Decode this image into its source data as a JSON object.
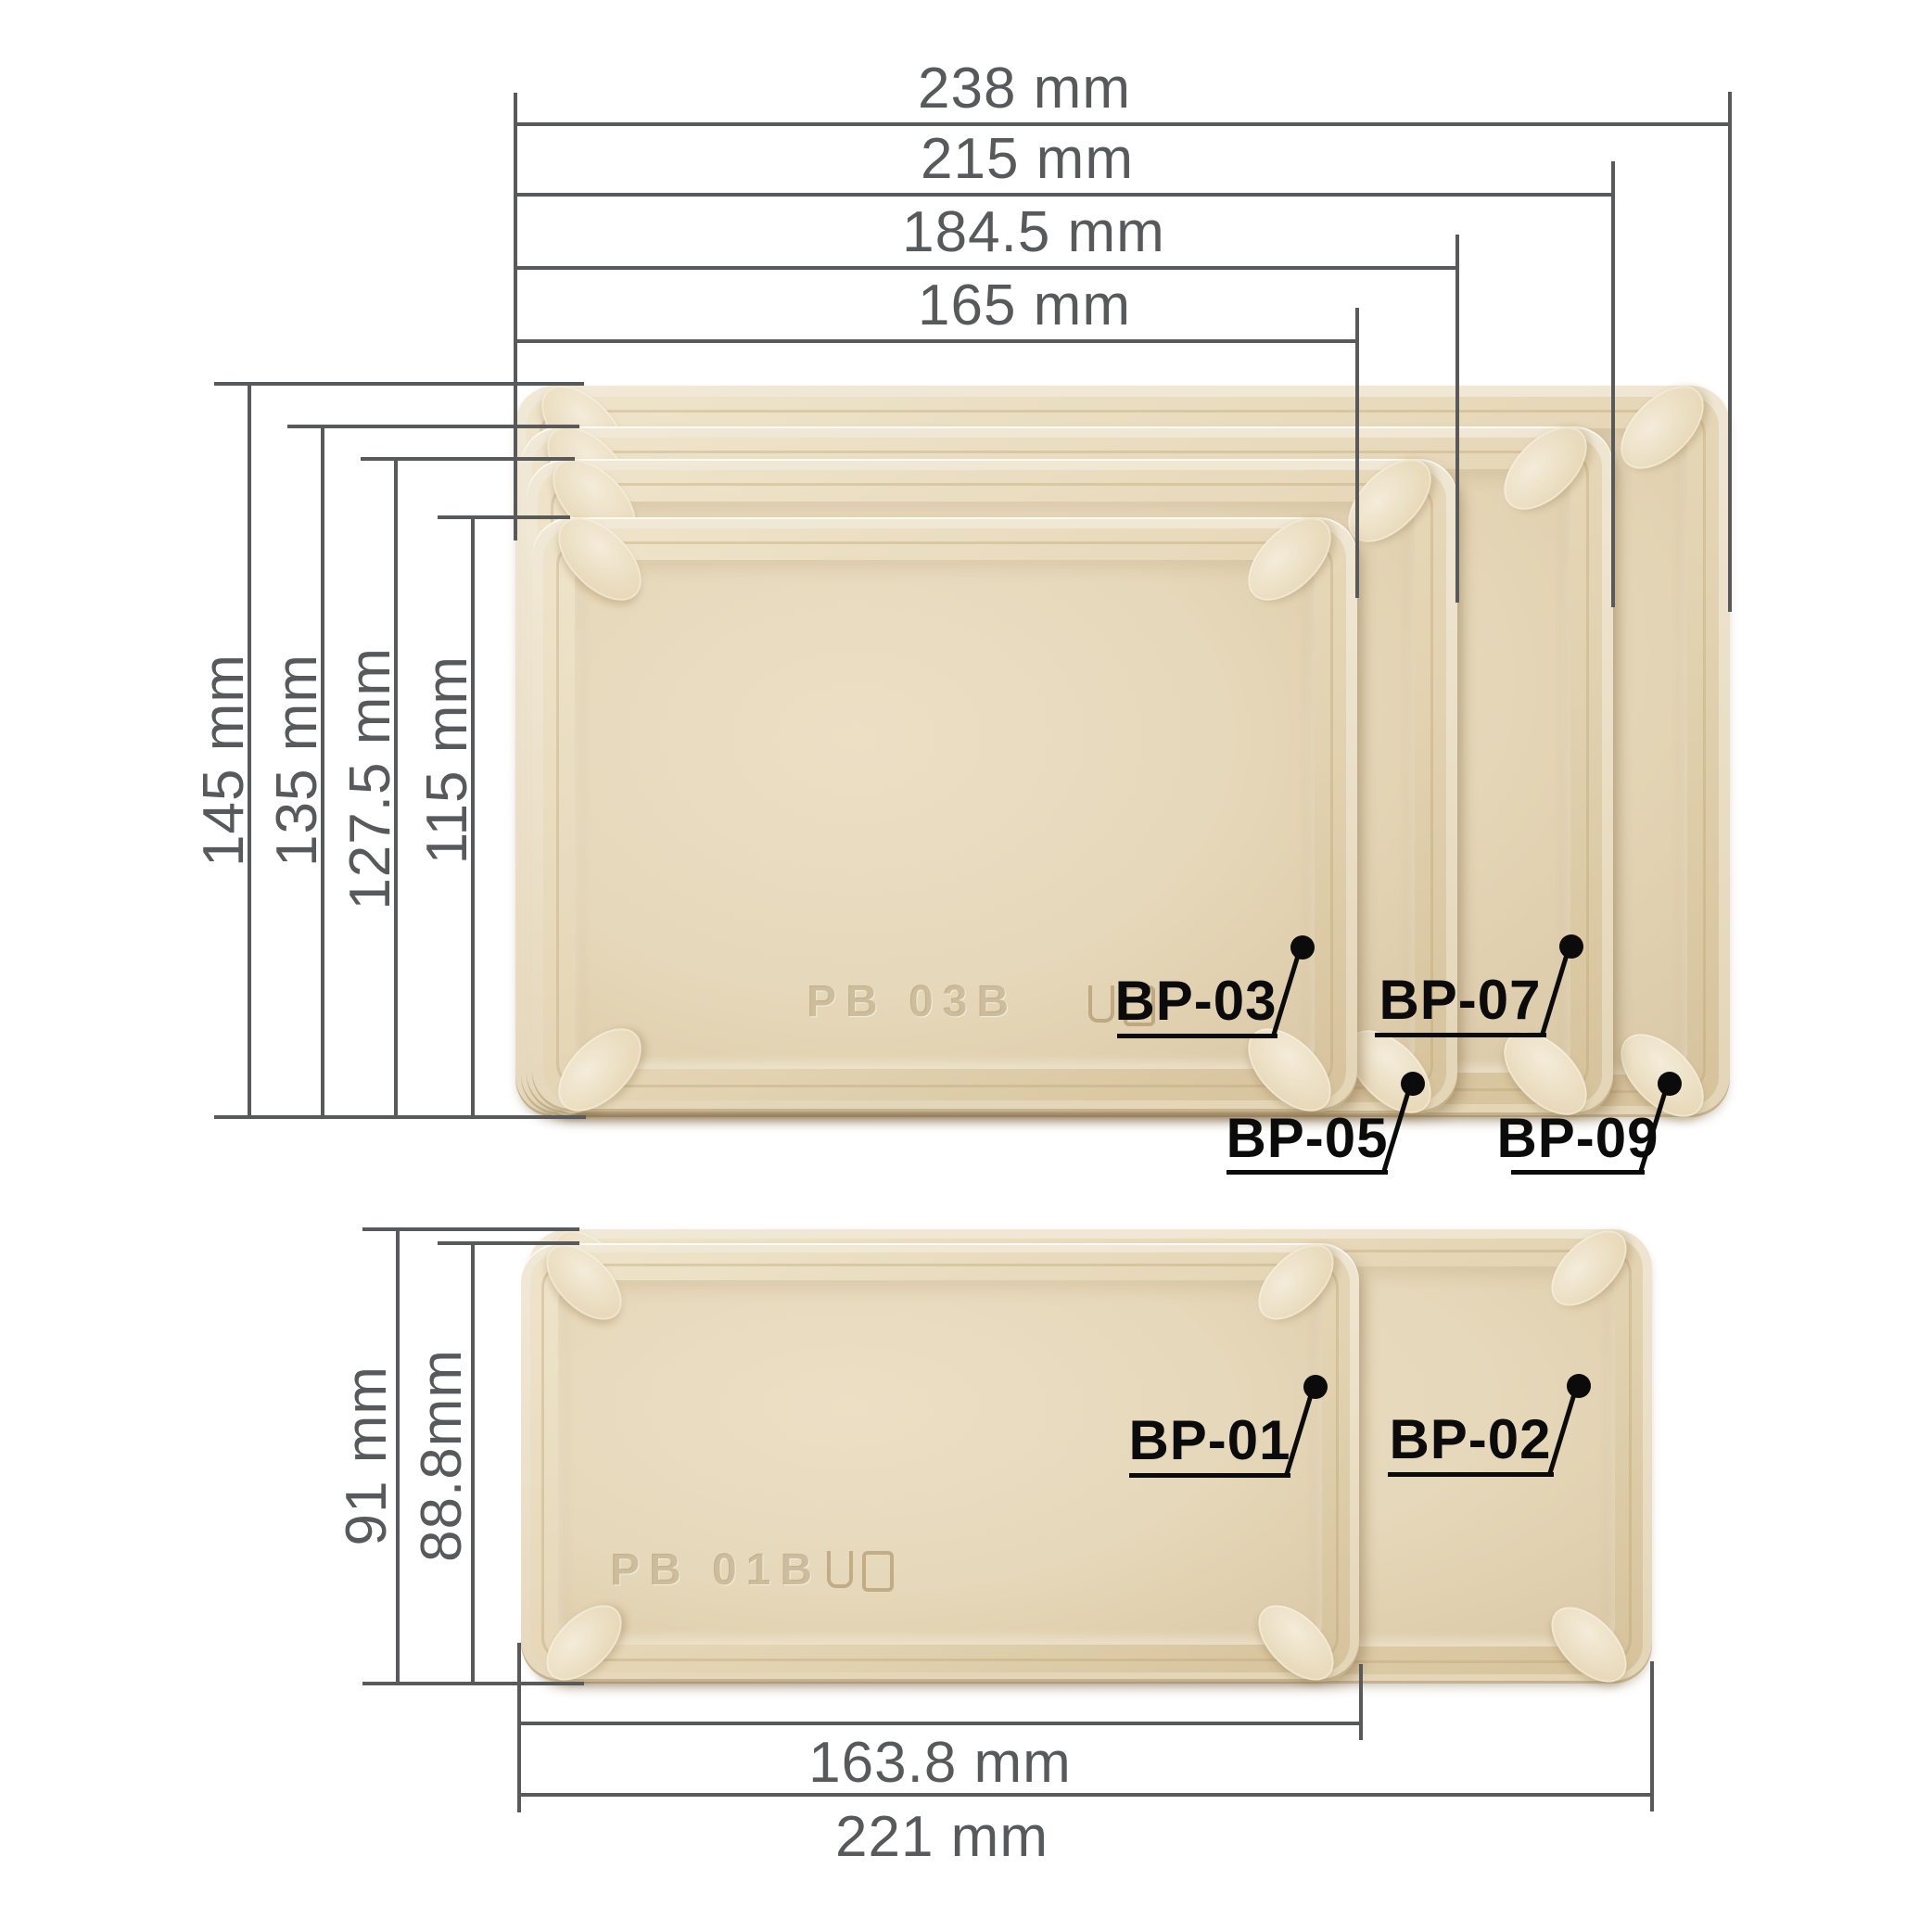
{
  "colors": {
    "background": "#ffffff",
    "dimension_gray": "#58595b",
    "callout_black": "#0b0b0b",
    "tray_rim": "#efe6d2",
    "tray_wall": "#e2d2b0",
    "tray_floor": "#e6d8ba"
  },
  "top_section": {
    "width_dims": [
      {
        "label": "238 mm"
      },
      {
        "label": "215 mm"
      },
      {
        "label": "184.5 mm"
      },
      {
        "label": "165 mm"
      }
    ],
    "height_dims": [
      {
        "label": "145 mm"
      },
      {
        "label": "135 mm"
      },
      {
        "label": "127.5 mm"
      },
      {
        "label": "115 mm"
      }
    ],
    "callouts": [
      {
        "label": "BP-03"
      },
      {
        "label": "BP-07"
      },
      {
        "label": "BP-05"
      },
      {
        "label": "BP-09"
      }
    ],
    "embossed_text": "PB 03B",
    "embossed_icon": "glass-fork-icon"
  },
  "bottom_section": {
    "width_dims": [
      {
        "label": "163.8 mm"
      },
      {
        "label": "221 mm"
      }
    ],
    "height_dims": [
      {
        "label": "91 mm"
      },
      {
        "label": "88.8mm"
      }
    ],
    "callouts": [
      {
        "label": "BP-01"
      },
      {
        "label": "BP-02"
      }
    ],
    "embossed_text": "PB 01B",
    "embossed_icon": "glass-fork-icon"
  }
}
